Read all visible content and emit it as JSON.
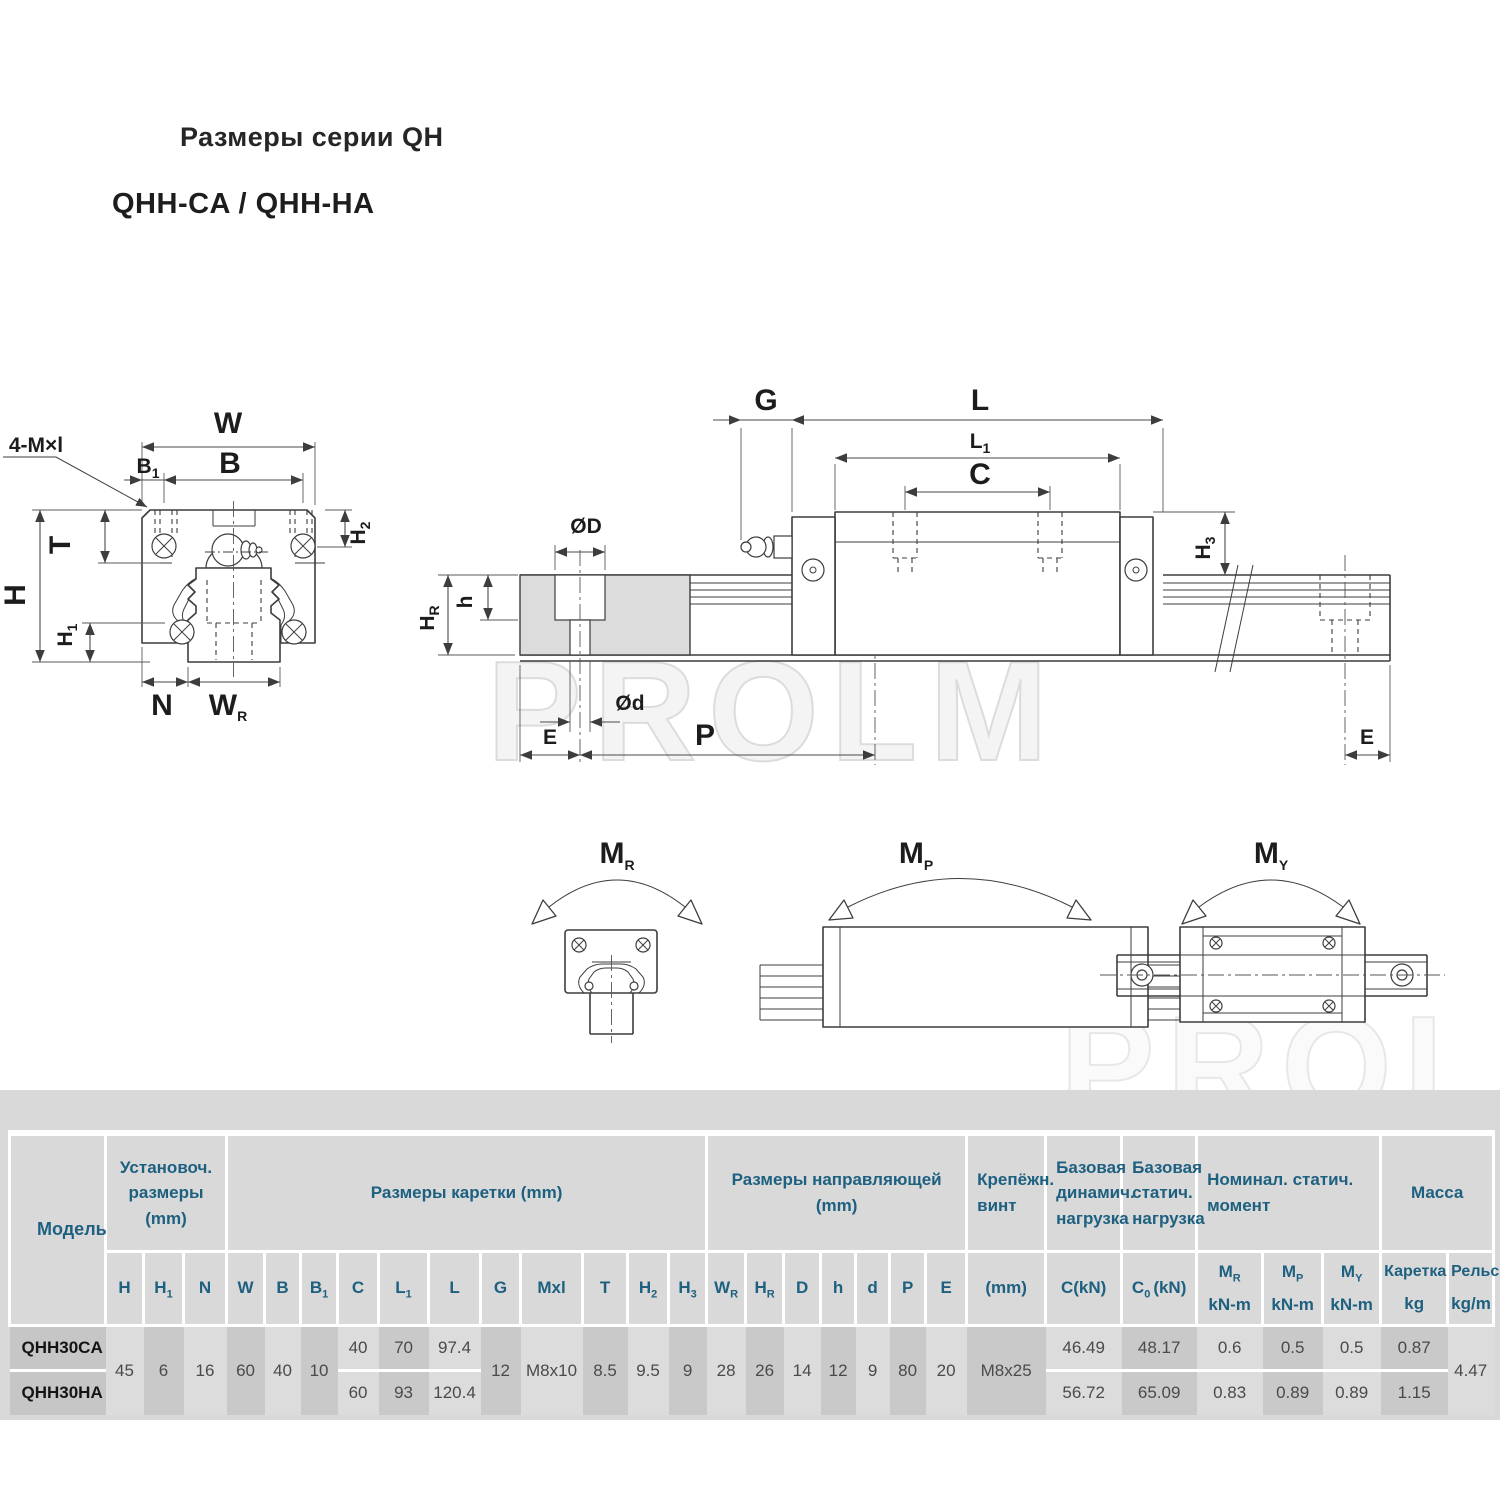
{
  "page": {
    "title": "Размеры серии QH",
    "subtitle": "QHH-CA / QHH-HA",
    "watermark": "PROLM"
  },
  "drawing": {
    "front": {
      "note": "4-M×l",
      "w": "W",
      "b": "B",
      "b1": {
        "t": "B",
        "s": "1"
      },
      "t": "T",
      "h": "H",
      "h1": {
        "t": "H",
        "s": "1"
      },
      "h2": {
        "t": "H",
        "s": "2"
      },
      "n": "N",
      "wr": {
        "t": "W",
        "s": "R"
      }
    },
    "side": {
      "g": "G",
      "l": "L",
      "l1": {
        "t": "L",
        "s": "1"
      },
      "c": "C",
      "dD": "ØD",
      "h": "h",
      "hr": {
        "t": "H",
        "s": "R"
      },
      "h3": {
        "t": "H",
        "s": "3"
      },
      "dd": "Ød",
      "e1": "E",
      "p": "P",
      "e2": "E"
    },
    "moments": {
      "mr": {
        "t": "M",
        "s": "R"
      },
      "mp": {
        "t": "M",
        "s": "P"
      },
      "my": {
        "t": "M",
        "s": "Y"
      }
    }
  },
  "table": {
    "model_header": "Модель",
    "groups": [
      {
        "label": "Установоч.\nразмеры\n(mm)"
      },
      {
        "label": "Размеры каретки (mm)"
      },
      {
        "label": "Размеры направляющей\n(mm)"
      },
      {
        "label": "Крепёжн.\nвинт"
      },
      {
        "label": "Базовая\nдинамич.\nнагрузка"
      },
      {
        "label": "Базовая\nстатич.\nнагрузка"
      },
      {
        "label": "Номинал. статич.\nмомент"
      },
      {
        "label": "Масса"
      }
    ],
    "columns": [
      {
        "base": "H"
      },
      {
        "base": "H",
        "sub": "1"
      },
      {
        "base": "N"
      },
      {
        "base": "W"
      },
      {
        "base": "B"
      },
      {
        "base": "B",
        "sub": "1"
      },
      {
        "base": "C"
      },
      {
        "base": "L",
        "sub": "1"
      },
      {
        "base": "L"
      },
      {
        "base": "G"
      },
      {
        "base": "Mxl"
      },
      {
        "base": "T"
      },
      {
        "base": "H",
        "sub": "2"
      },
      {
        "base": "H",
        "sub": "3"
      },
      {
        "base": "W",
        "sub": "R"
      },
      {
        "base": "H",
        "sub": "R"
      },
      {
        "base": "D"
      },
      {
        "base": "h"
      },
      {
        "base": "d"
      },
      {
        "base": "P"
      },
      {
        "base": "E"
      },
      {
        "base": "(mm)"
      },
      {
        "base": "C(kN)"
      },
      {
        "base": "C",
        "sub": "0",
        "suffix": "(kN)"
      },
      {
        "base": "M",
        "sub": "R",
        "unit": "kN-m"
      },
      {
        "base": "M",
        "sub": "P",
        "unit": "kN-m"
      },
      {
        "base": "M",
        "sub": "Y",
        "unit": "kN-m"
      },
      {
        "base": "Каретка",
        "unit": "kg"
      },
      {
        "base": "Рельс",
        "unit": "kg/m"
      }
    ],
    "shared": {
      "h": "45",
      "h1": "6",
      "n": "16",
      "w": "60",
      "b": "40",
      "b1": "10",
      "g": "12",
      "mxl": "M8x10",
      "t": "8.5",
      "h2": "9.5",
      "h3": "9",
      "wr": "28",
      "hr": "26",
      "d_cap": "14",
      "h_small": "12",
      "d": "9",
      "p": "80",
      "e": "20",
      "screw": "M8x25",
      "rail_kg_m": "4.47"
    },
    "rows": [
      {
        "model": "QHH30CA",
        "c": "40",
        "l1": "70",
        "l": "97.4",
        "c_kn": "46.49",
        "c0_kn": "48.17",
        "mr": "0.6",
        "mp": "0.5",
        "my": "0.5",
        "kg": "0.87"
      },
      {
        "model": "QHH30HA",
        "c": "60",
        "l1": "93",
        "l": "120.4",
        "c_kn": "56.72",
        "c0_kn": "65.09",
        "mr": "0.83",
        "mp": "0.89",
        "my": "0.89",
        "kg": "1.15"
      }
    ]
  }
}
